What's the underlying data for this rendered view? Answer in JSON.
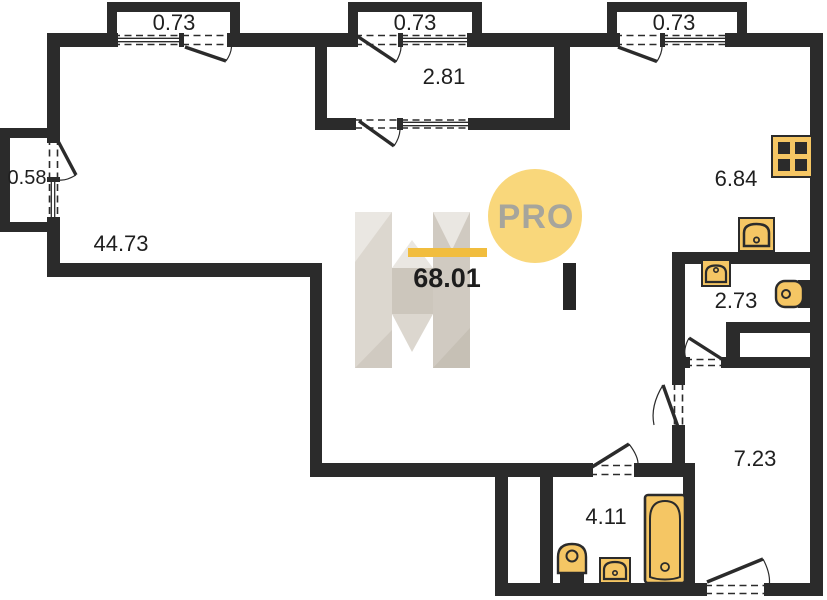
{
  "colors": {
    "wall": "#2b2b2b",
    "line": "#2b2b2b",
    "fixture": "#f5c664",
    "label": "#1f1f1f",
    "wm-yellow": "#f9d77b",
    "wm-orange": "#f1bd3e",
    "wm-gray": "#a6a59c",
    "wm-dark": "#262626",
    "h-base": "#dcd7cf",
    "h-light": "#eae7e2",
    "h-mid": "#d0cac1",
    "h-dark": "#c6c0b5",
    "h-bar": "#ccc6bc"
  },
  "plan": {
    "watermark": {
      "brand": "PRO",
      "total_area": "68.01"
    },
    "rooms": [
      {
        "id": "living-room",
        "area": "44.73"
      },
      {
        "id": "loggia",
        "area": "2.81"
      },
      {
        "id": "kitchen",
        "area": "6.84"
      },
      {
        "id": "wc",
        "area": "2.73"
      },
      {
        "id": "hall",
        "area": "7.23"
      },
      {
        "id": "bathroom",
        "area": "4.11"
      },
      {
        "id": "balcony-top-left",
        "area": "0.73"
      },
      {
        "id": "balcony-top-middle",
        "area": "0.73"
      },
      {
        "id": "balcony-top-right",
        "area": "0.73"
      },
      {
        "id": "balcony-left",
        "area": "0.58"
      }
    ],
    "fixtures": [
      {
        "room": "kitchen",
        "type": "stove"
      },
      {
        "room": "kitchen",
        "type": "sink"
      },
      {
        "room": "wc",
        "type": "sink"
      },
      {
        "room": "wc",
        "type": "toilet"
      },
      {
        "room": "bathroom",
        "type": "toilet"
      },
      {
        "room": "bathroom",
        "type": "sink"
      },
      {
        "room": "bathroom",
        "type": "bathtub"
      }
    ]
  }
}
